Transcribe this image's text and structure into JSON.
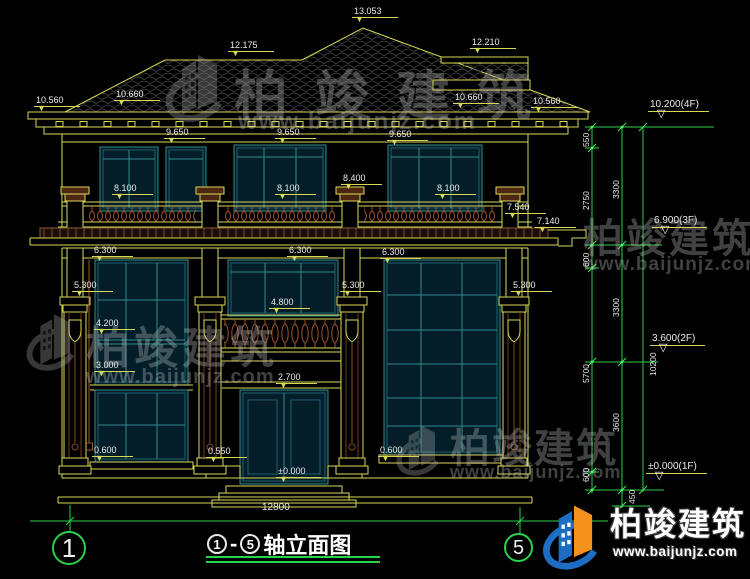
{
  "icons": {
    "tri_down_filled": "▼",
    "tri_down_open": "▽"
  },
  "watermark": {
    "name": "柏竣建筑",
    "url": "www.baijunjz.com"
  },
  "brand": {
    "name": "柏竣建筑",
    "url": "www.baijunjz.com"
  },
  "title": {
    "axis_start": "1",
    "separator": "-",
    "axis_end": "5",
    "text": "轴立面图"
  },
  "axes": {
    "left": "1",
    "right": "5"
  },
  "dims": {
    "overall_width": "12800"
  },
  "levels": [
    {
      "text": "13.053"
    },
    {
      "text": "12.175"
    },
    {
      "text": "12.210"
    },
    {
      "text": "10.560"
    },
    {
      "text": "10.660"
    },
    {
      "text": "10.660"
    },
    {
      "text": "10.560"
    },
    {
      "text": "9.650"
    },
    {
      "text": "9.650"
    },
    {
      "text": "9.650"
    },
    {
      "text": "8.100"
    },
    {
      "text": "8.100"
    },
    {
      "text": "8.400"
    },
    {
      "text": "8.100"
    },
    {
      "text": "7.540"
    },
    {
      "text": "7.140"
    },
    {
      "text": "6.300"
    },
    {
      "text": "6.300"
    },
    {
      "text": "6.300"
    },
    {
      "text": "5.300"
    },
    {
      "text": "5.300"
    },
    {
      "text": "5.300"
    },
    {
      "text": "4.800"
    },
    {
      "text": "4.200"
    },
    {
      "text": "3.000"
    },
    {
      "text": "2.700"
    },
    {
      "text": "0.600"
    },
    {
      "text": "0.550"
    },
    {
      "text": "0.600"
    },
    {
      "text": "±0.000"
    }
  ],
  "floors": [
    {
      "text": "10.200(4F)"
    },
    {
      "text": "6.900(3F)"
    },
    {
      "text": "3.600(2F)"
    },
    {
      "text": "±0.000(1F)"
    }
  ],
  "chains": [
    {
      "text": "550"
    },
    {
      "text": "2750"
    },
    {
      "text": "600"
    },
    {
      "text": "5700"
    },
    {
      "text": "600"
    },
    {
      "text": "3300"
    },
    {
      "text": "3300"
    },
    {
      "text": "3600"
    },
    {
      "text": "450"
    },
    {
      "text": "10200"
    }
  ]
}
